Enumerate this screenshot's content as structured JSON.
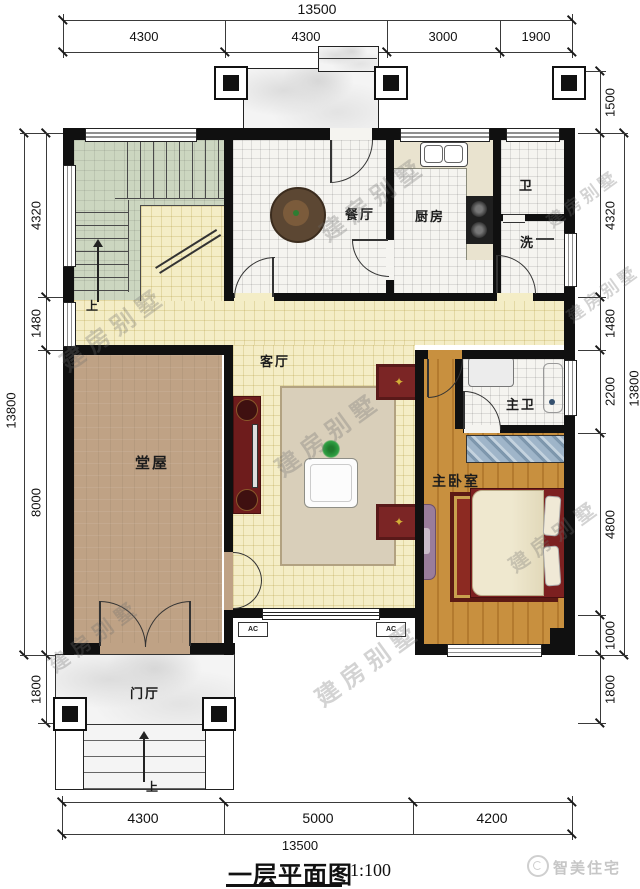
{
  "title": {
    "text": "一层平面图",
    "scale": "1:100"
  },
  "watermark_text": "建房别墅",
  "brand_text": "智美住宅",
  "dimensions": {
    "top": {
      "total": "13500",
      "segments": [
        "4300",
        "4300",
        "3000",
        "1900"
      ]
    },
    "bottom": {
      "total": "13500",
      "segments": [
        "4300",
        "5000",
        "4200"
      ]
    },
    "left": {
      "total": "13800",
      "segments": [
        "4320",
        "1480",
        "8000",
        "1800"
      ]
    },
    "right": {
      "total": "13800",
      "segments": [
        "1500",
        "4320",
        "1480",
        "2200",
        "4800",
        "1000",
        "1800"
      ]
    }
  },
  "rooms": {
    "dining": "餐厅",
    "kitchen": "厨房",
    "wc": "卫",
    "laundry": "洗",
    "living": "客厅",
    "hall": "堂屋",
    "master_bedroom": "主卧室",
    "master_bath": "主卫",
    "foyer": "门厅"
  },
  "annotations": {
    "up": "上",
    "ac": "AC"
  }
}
